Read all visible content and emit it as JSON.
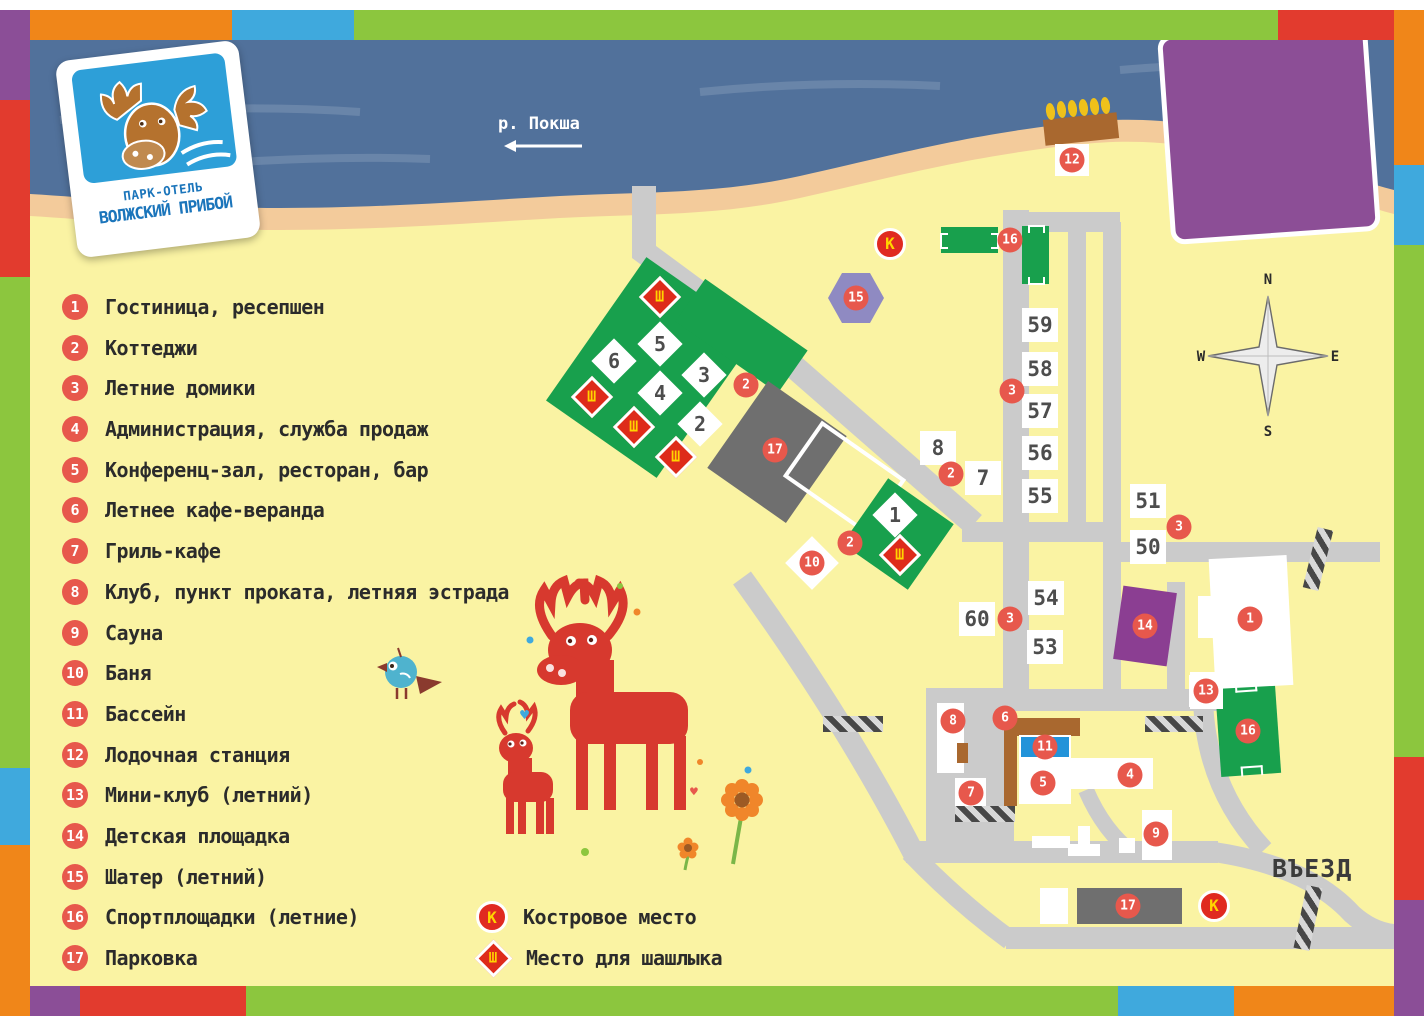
{
  "logo": {
    "top": "ПАРК-ОТЕЛЬ",
    "bottom": "ВОЛЖСКИЙ ПРИБОЙ"
  },
  "legend": {
    "items": [
      {
        "n": "1",
        "label": "Гостиница, ресепшен"
      },
      {
        "n": "2",
        "label": "Коттеджи"
      },
      {
        "n": "3",
        "label": "Летние домики"
      },
      {
        "n": "4",
        "label": "Администрация, служба продаж"
      },
      {
        "n": "5",
        "label": "Конференц-зал, ресторан, бар"
      },
      {
        "n": "6",
        "label": "Летнее кафе-веранда"
      },
      {
        "n": "7",
        "label": "Гриль-кафе"
      },
      {
        "n": "8",
        "label": "Клуб, пункт проката, летняя эстрада"
      },
      {
        "n": "9",
        "label": "Сауна"
      },
      {
        "n": "10",
        "label": "Баня"
      },
      {
        "n": "11",
        "label": "Бассейн"
      },
      {
        "n": "12",
        "label": "Лодочная станция"
      },
      {
        "n": "13",
        "label": "Мини-клуб (летний)"
      },
      {
        "n": "14",
        "label": "Детская площадка"
      },
      {
        "n": "15",
        "label": "Шатер (летний)"
      },
      {
        "n": "16",
        "label": "Спортплощадки (летние)"
      },
      {
        "n": "17",
        "label": "Парковка"
      }
    ],
    "symbols": [
      {
        "key": "К",
        "label": "Костровое место"
      },
      {
        "key": "Ш",
        "label": "Место для шашлыка"
      }
    ]
  },
  "map": {
    "river_label": "р. Покша",
    "entrance_label": "ВЪЕЗД",
    "compass": {
      "n": "N",
      "e": "E",
      "s": "S",
      "w": "W"
    },
    "sh_letter": "Ш",
    "k_letter": "К",
    "markers": [
      {
        "n": "12",
        "x": 1072,
        "y": 160,
        "plate": "square"
      },
      {
        "n": "16",
        "x": 1010,
        "y": 240
      },
      {
        "n": "15",
        "x": 856,
        "y": 298
      },
      {
        "n": "2",
        "x": 746,
        "y": 385
      },
      {
        "n": "3",
        "x": 1012,
        "y": 391
      },
      {
        "n": "17",
        "x": 775,
        "y": 450
      },
      {
        "n": "2",
        "x": 951,
        "y": 474
      },
      {
        "n": "3",
        "x": 1179,
        "y": 527
      },
      {
        "n": "2",
        "x": 850,
        "y": 543
      },
      {
        "n": "10",
        "x": 812,
        "y": 563,
        "plate": "diamond"
      },
      {
        "n": "3",
        "x": 1010,
        "y": 619
      },
      {
        "n": "1",
        "x": 1250,
        "y": 619
      },
      {
        "n": "14",
        "x": 1145,
        "y": 626
      },
      {
        "n": "13",
        "x": 1206,
        "y": 691,
        "plate": "square"
      },
      {
        "n": "8",
        "x": 953,
        "y": 721
      },
      {
        "n": "6",
        "x": 1005,
        "y": 718
      },
      {
        "n": "16",
        "x": 1248,
        "y": 731
      },
      {
        "n": "11",
        "x": 1045,
        "y": 747
      },
      {
        "n": "4",
        "x": 1130,
        "y": 775
      },
      {
        "n": "5",
        "x": 1043,
        "y": 783
      },
      {
        "n": "7",
        "x": 971,
        "y": 793
      },
      {
        "n": "9",
        "x": 1156,
        "y": 834
      },
      {
        "n": "17",
        "x": 1128,
        "y": 906
      }
    ],
    "number_plates": [
      {
        "n": "59",
        "x": 1040,
        "y": 325
      },
      {
        "n": "58",
        "x": 1040,
        "y": 369
      },
      {
        "n": "57",
        "x": 1040,
        "y": 411
      },
      {
        "n": "56",
        "x": 1040,
        "y": 453
      },
      {
        "n": "55",
        "x": 1040,
        "y": 496
      },
      {
        "n": "51",
        "x": 1148,
        "y": 501
      },
      {
        "n": "50",
        "x": 1148,
        "y": 547
      },
      {
        "n": "54",
        "x": 1046,
        "y": 598
      },
      {
        "n": "60",
        "x": 977,
        "y": 619
      },
      {
        "n": "53",
        "x": 1045,
        "y": 647
      },
      {
        "n": "8",
        "x": 938,
        "y": 448
      },
      {
        "n": "7",
        "x": 983,
        "y": 478
      }
    ],
    "cottage_numbers": [
      {
        "n": "5",
        "x": 660,
        "y": 344
      },
      {
        "n": "6",
        "x": 614,
        "y": 361
      },
      {
        "n": "3",
        "x": 704,
        "y": 375
      },
      {
        "n": "4",
        "x": 660,
        "y": 393
      },
      {
        "n": "2",
        "x": 700,
        "y": 424
      },
      {
        "n": "1",
        "x": 895,
        "y": 515
      }
    ],
    "sh_points": [
      {
        "x": 660,
        "y": 297
      },
      {
        "x": 592,
        "y": 397
      },
      {
        "x": 634,
        "y": 427
      },
      {
        "x": 676,
        "y": 457
      },
      {
        "x": 900,
        "y": 555
      }
    ],
    "k_points": [
      {
        "x": 890,
        "y": 244
      },
      {
        "x": 1214,
        "y": 906
      }
    ]
  },
  "palette": {
    "land": "#FAF3A3",
    "water": "#51719B",
    "sand": "#F3CB9B",
    "road": "#CBCBCB",
    "green": "#18A04D",
    "marker_red": "#E7584C",
    "sh_red": "#DE2B1A",
    "sh_yellow": "#FFD400",
    "parking_gray": "#6F6F6F",
    "purple": "#8C4E96",
    "lavender": "#8F8AC2",
    "pool_blue": "#2293D9",
    "brown": "#A9682F",
    "frame_orange": "#F08619",
    "frame_blue": "#3FA9DD",
    "frame_green": "#8CC63E",
    "frame_red": "#E23B2E",
    "frame_purple": "#8B4E97"
  }
}
